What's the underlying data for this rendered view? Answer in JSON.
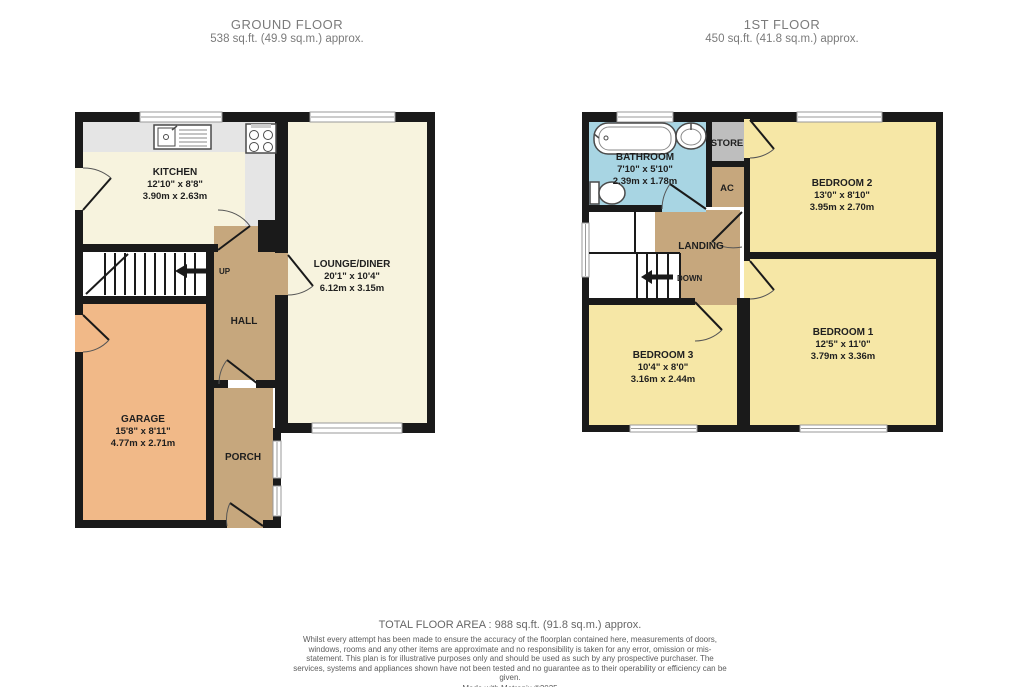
{
  "ground_floor": {
    "title": "GROUND FLOOR",
    "area": "538 sq.ft. (49.9 sq.m.) approx.",
    "rooms": {
      "kitchen": {
        "name": "KITCHEN",
        "imperial": "12'10\" x 8'8\"",
        "metric": "3.90m x 2.63m"
      },
      "lounge": {
        "name": "LOUNGE/DINER",
        "imperial": "20'1\" x 10'4\"",
        "metric": "6.12m x 3.15m"
      },
      "garage": {
        "name": "GARAGE",
        "imperial": "15'8\" x 8'11\"",
        "metric": "4.77m x 2.71m"
      },
      "hall": {
        "name": "HALL"
      },
      "porch": {
        "name": "PORCH"
      }
    },
    "stair_label": "UP"
  },
  "first_floor": {
    "title": "1ST FLOOR",
    "area": "450 sq.ft. (41.8 sq.m.) approx.",
    "rooms": {
      "bathroom": {
        "name": "BATHROOM",
        "imperial": "7'10\" x 5'10\"",
        "metric": "2.39m x 1.78m"
      },
      "bedroom2": {
        "name": "BEDROOM 2",
        "imperial": "13'0\" x 8'10\"",
        "metric": "3.95m x 2.70m"
      },
      "bedroom1": {
        "name": "BEDROOM 1",
        "imperial": "12'5\" x 11'0\"",
        "metric": "3.79m x 3.36m"
      },
      "bedroom3": {
        "name": "BEDROOM 3",
        "imperial": "10'4\" x 8'0\"",
        "metric": "3.16m x 2.44m"
      },
      "landing": {
        "name": "LANDING"
      },
      "store": {
        "name": "STORE"
      },
      "ac": {
        "name": "AC"
      }
    },
    "stair_label": "DOWN"
  },
  "footer": {
    "total": "TOTAL FLOOR AREA : 988 sq.ft. (91.8 sq.m.) approx.",
    "disclaimer": "Whilst every attempt has been made to ensure the accuracy of the floorplan contained here, measurements of doors, windows, rooms and any other items are approximate and no responsibility is taken for any error, omission or mis-statement. This plan is for illustrative purposes only and should be used as such by any prospective purchaser. The services, systems and appliances shown have not been tested and no guarantee as to their operability or efficiency can be given.",
    "credit": "Made with Metropix ©2025"
  },
  "colors": {
    "wall": "#1a1a1a",
    "cream": "#f7f3de",
    "bedroom_yellow": "#f6e7a6",
    "tan": "#c6a77d",
    "garage_orange": "#f1b988",
    "bathroom_blue": "#a8d5e3",
    "store_grey": "#bebebe",
    "counter_grey": "#e5e5e5"
  }
}
